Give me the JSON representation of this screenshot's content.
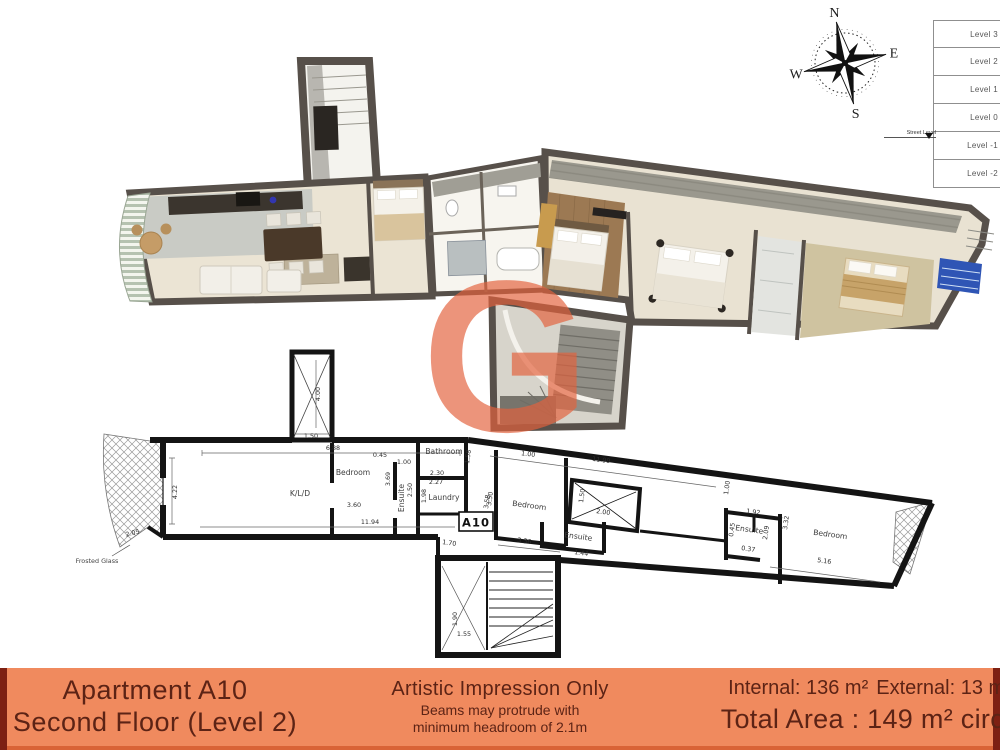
{
  "compass": {
    "north": "N",
    "east": "E",
    "south": "S",
    "west": "W"
  },
  "level_panel": {
    "street_level_label": "Street Level",
    "levels": [
      "Level 3",
      "Level 2",
      "Level 1",
      "Level 0",
      "Level -1",
      "Level -2"
    ]
  },
  "watermark": {
    "letter": "G"
  },
  "plan2d": {
    "unit_label": "A10",
    "frosted_glass": "Frosted Glass",
    "rooms": {
      "kld": "K/L/D",
      "bedroom1": "Bedroom",
      "ensuite1": "Ensuite",
      "bathroom": "Bathroom",
      "laundry": "Laundry",
      "bedroom2": "Bedroom",
      "ensuite2": "Ensuite",
      "ensuite3": "Ensuite",
      "bedroom3": "Bedroom"
    },
    "dims": {
      "shaft_w": "1.50",
      "shaft_h": "4.00",
      "kld_top": "6.88",
      "kld_left": "4.22",
      "kld_bottom": "11.94",
      "balcony_edge": "2.05",
      "bed1_w": "3.60",
      "bed1_h": "3.69",
      "hall_w": "0.45",
      "door1": "1.00",
      "ensuite1_h": "2.50",
      "bath_w": "2.30",
      "laundry_top": "2.27",
      "bath_h": "1.58",
      "laundry_h": "1.98",
      "laundry_w": "1.70",
      "hall_h": "3.50",
      "wing_top": "11.99",
      "door2": "1.00",
      "bed2_h": "3.58",
      "bed2_w": "3.36",
      "shaft2_h": "1.50",
      "shaft2_w": "2.00",
      "ensuite2_w": "1.44",
      "door3": "1.00",
      "ensuite3_top": "1.92",
      "ensuite3_left": "0.45",
      "ensuite3_right": "2.09",
      "ensuite3_bottom": "0.37",
      "bed3_h": "3.32",
      "bed3_w": "5.16",
      "stair_h": "1.90",
      "stair_w": "1.55"
    }
  },
  "footer": {
    "apartment_title": "Apartment A10",
    "apartment_subtitle": "Second Floor (Level 2)",
    "disclaimer_title": "Artistic Impression Only",
    "disclaimer_line1": "Beams may protrude with",
    "disclaimer_line2": "minimum headroom of 2.1m",
    "internal_area": "Internal: 136 m²",
    "external_area": "External: 13 m²",
    "total_area": "Total Area : 149 m² circa"
  }
}
